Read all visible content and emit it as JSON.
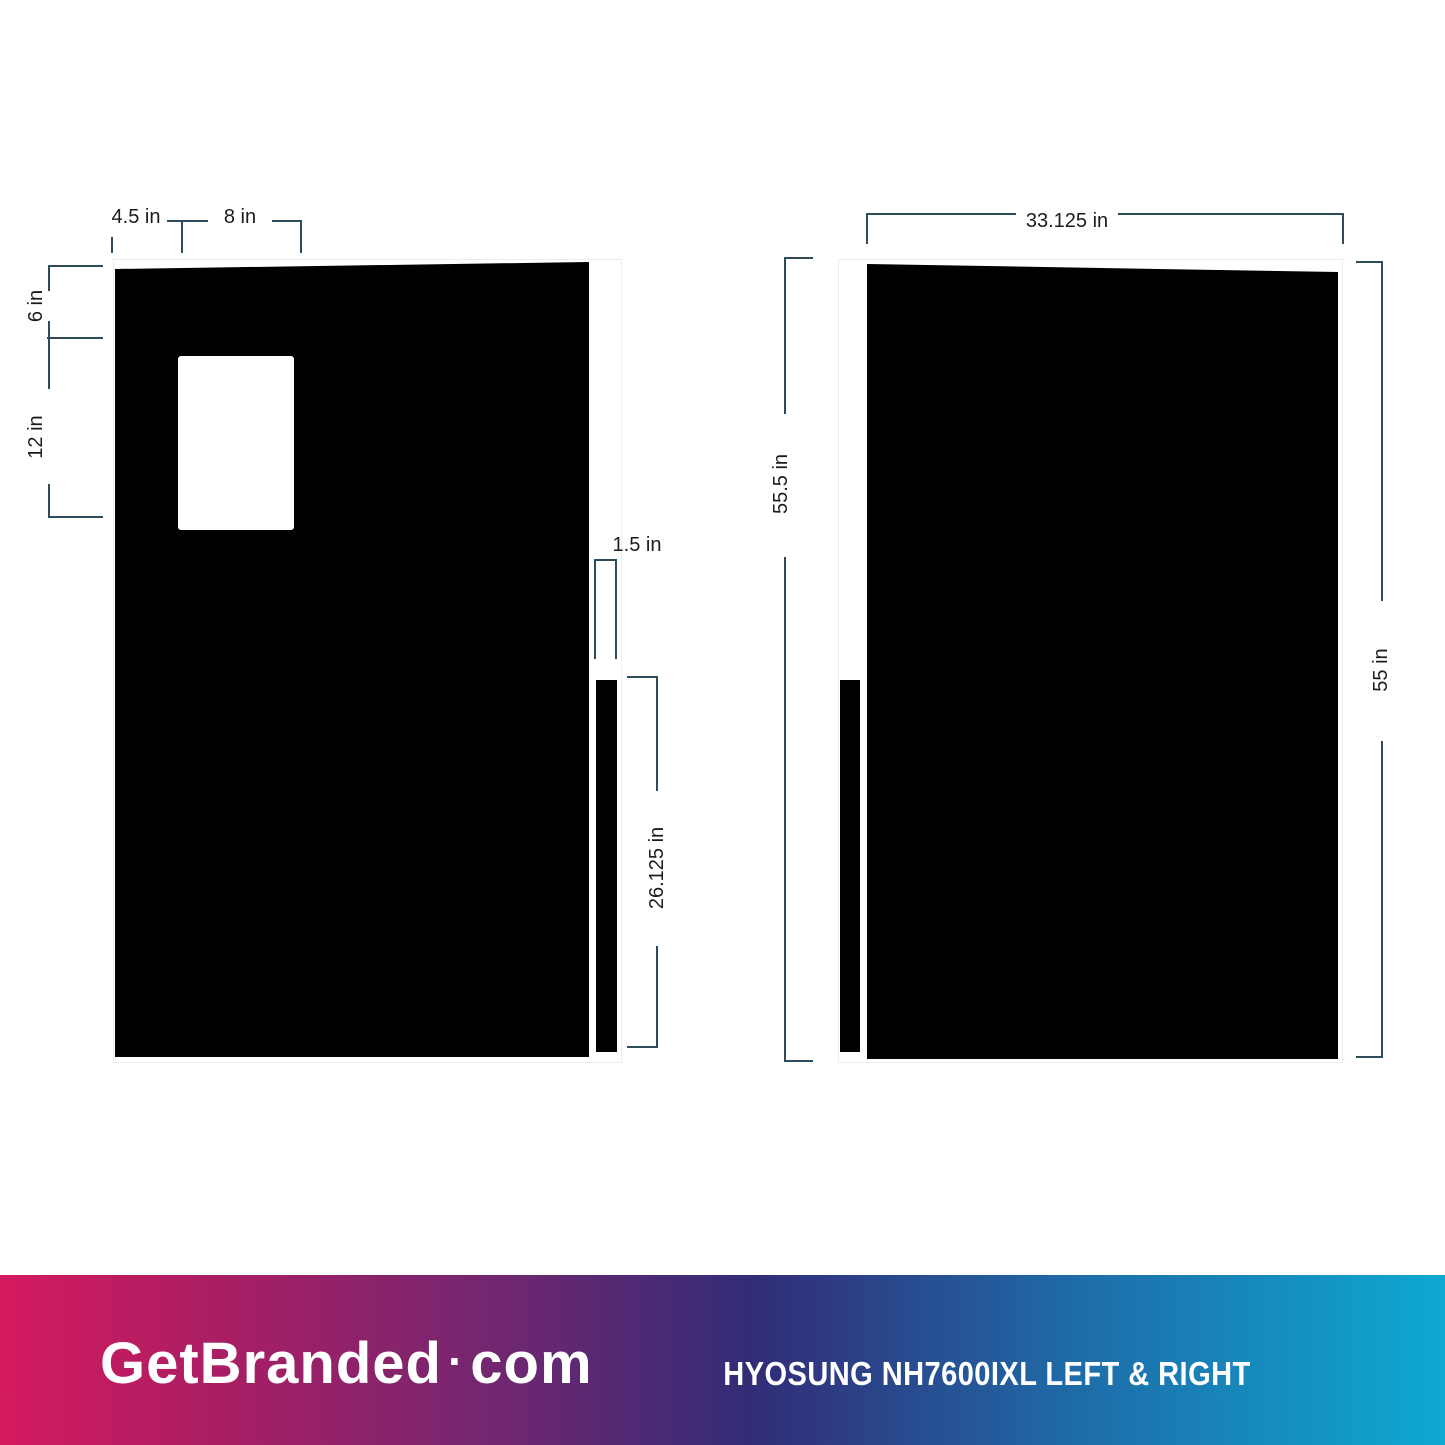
{
  "diagram": {
    "left_figure": {
      "name": "left side panel template",
      "labels": {
        "panel_left_to_cutout": "4.5 in",
        "cutout_width": "8 in",
        "top_to_cutout": "6 in",
        "cutout_height": "12 in",
        "strip_width": "1.5 in",
        "strip_length": "26.125 in"
      }
    },
    "right_figure": {
      "name": "right side panel template",
      "labels": {
        "panel_width": "33.125 in",
        "panel_height_left": "55.5 in",
        "panel_height_right": "55 in"
      }
    },
    "colors": {
      "panel_fill": "#000000",
      "cutout_fill": "#ffffff",
      "dimension_line": "#2d4b5b",
      "dimension_text": "#1c1c1c",
      "template_outline": "#ededed"
    }
  },
  "footer": {
    "brand_name": "GetBranded",
    "brand_separator": "·",
    "brand_tld": "com",
    "product_label": "HYOSUNG NH7600IXL LEFT & RIGHT",
    "text_color": "#ffffff",
    "gradient_stops": [
      "#d41a5e",
      "#a21f66",
      "#6f2770",
      "#322c77",
      "#1e6da9",
      "#0ea9d2"
    ]
  }
}
